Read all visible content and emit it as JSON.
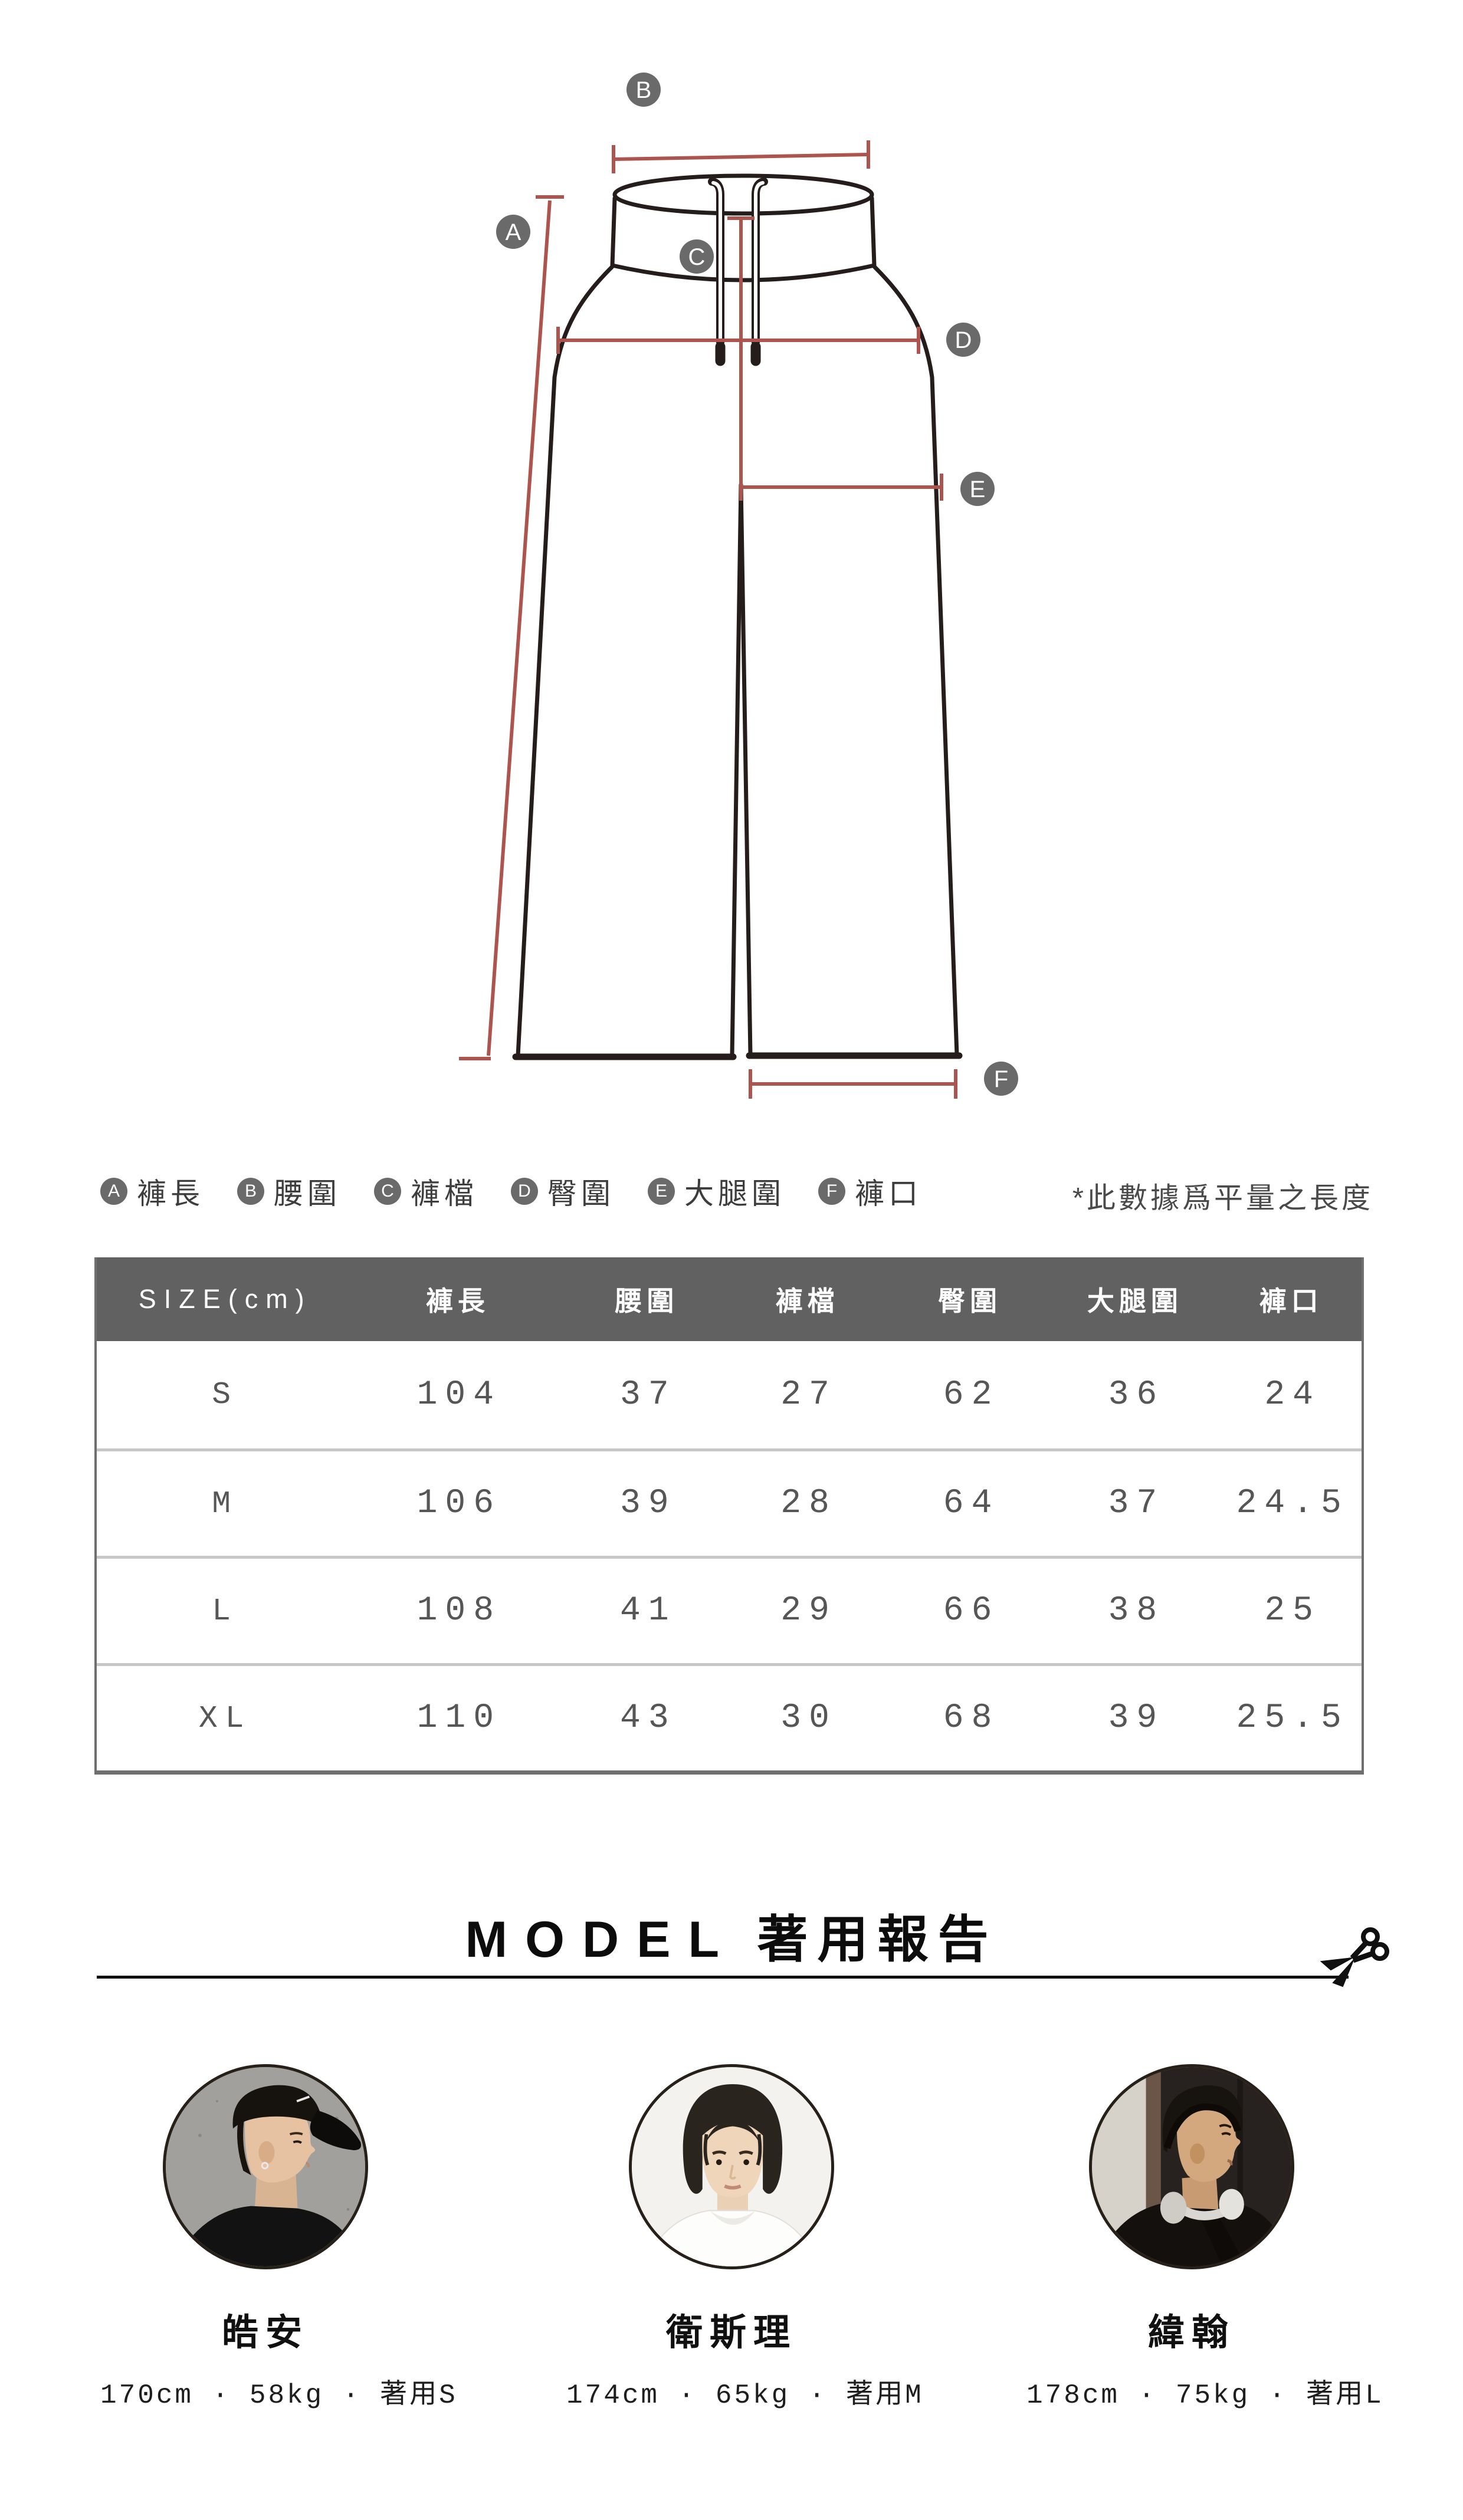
{
  "diagram": {
    "markers": [
      "A",
      "B",
      "C",
      "D",
      "E",
      "F"
    ],
    "colors": {
      "measure_line": "#ae544e",
      "garment_outline": "#241d1b",
      "marker_bg": "#6a6a6a"
    }
  },
  "legend": {
    "items": [
      {
        "letter": "A",
        "label": "褲長"
      },
      {
        "letter": "B",
        "label": "腰圍"
      },
      {
        "letter": "C",
        "label": "褲檔"
      },
      {
        "letter": "D",
        "label": "臀圍"
      },
      {
        "letter": "E",
        "label": "大腿圍"
      },
      {
        "letter": "F",
        "label": "褲口"
      }
    ],
    "note": "*此數據爲平量之長度"
  },
  "size_table": {
    "colors": {
      "header_bg": "#616161",
      "border": "#6f6f6f",
      "separator": "#c7c7c7"
    },
    "header": [
      "SIZE(cm)",
      "褲長",
      "腰圍",
      "褲檔",
      "臀圍",
      "大腿圍",
      "褲口"
    ],
    "rows": [
      {
        "size": "S",
        "values": [
          "104",
          "37",
          "27",
          "62",
          "36",
          "24"
        ]
      },
      {
        "size": "M",
        "values": [
          "106",
          "39",
          "28",
          "64",
          "37",
          "24.5"
        ]
      },
      {
        "size": "L",
        "values": [
          "108",
          "41",
          "29",
          "66",
          "38",
          "25"
        ]
      },
      {
        "size": "XL",
        "values": [
          "110",
          "43",
          "30",
          "68",
          "39",
          "25.5"
        ]
      }
    ]
  },
  "model_section": {
    "title_en": "MODEL",
    "title_zh": "著用報告",
    "models": [
      {
        "name": "皓安",
        "info": "170cm · 58kg · 著用S"
      },
      {
        "name": "衛斯理",
        "info": "174cm · 65kg · 著用M"
      },
      {
        "name": "緯翰",
        "info": "178cm · 75kg · 著用L"
      }
    ]
  }
}
